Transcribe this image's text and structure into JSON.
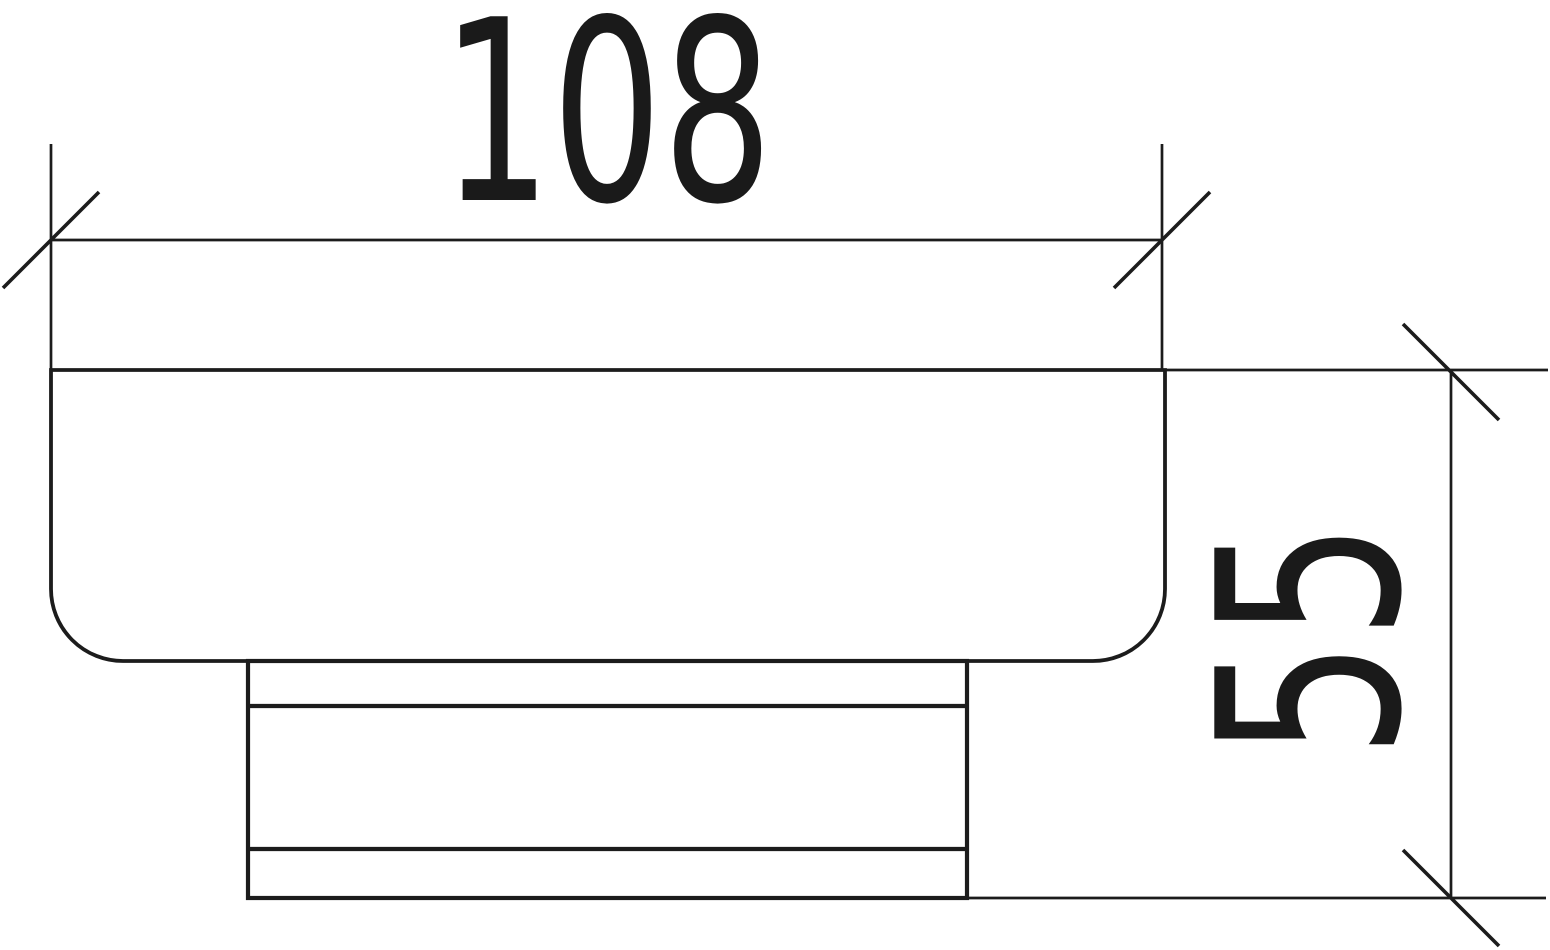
{
  "figure": {
    "type": "technical-drawing",
    "line_color": "#1c1c1c",
    "background_color": "#ffffff",
    "hatch_style": "45-degree crosshatch (knurling)"
  },
  "dimensions": {
    "width": {
      "value": "108",
      "orientation": "horizontal",
      "tick_style": "oblique-slash"
    },
    "height": {
      "value": "55",
      "orientation": "vertical",
      "tick_style": "oblique-slash"
    }
  }
}
